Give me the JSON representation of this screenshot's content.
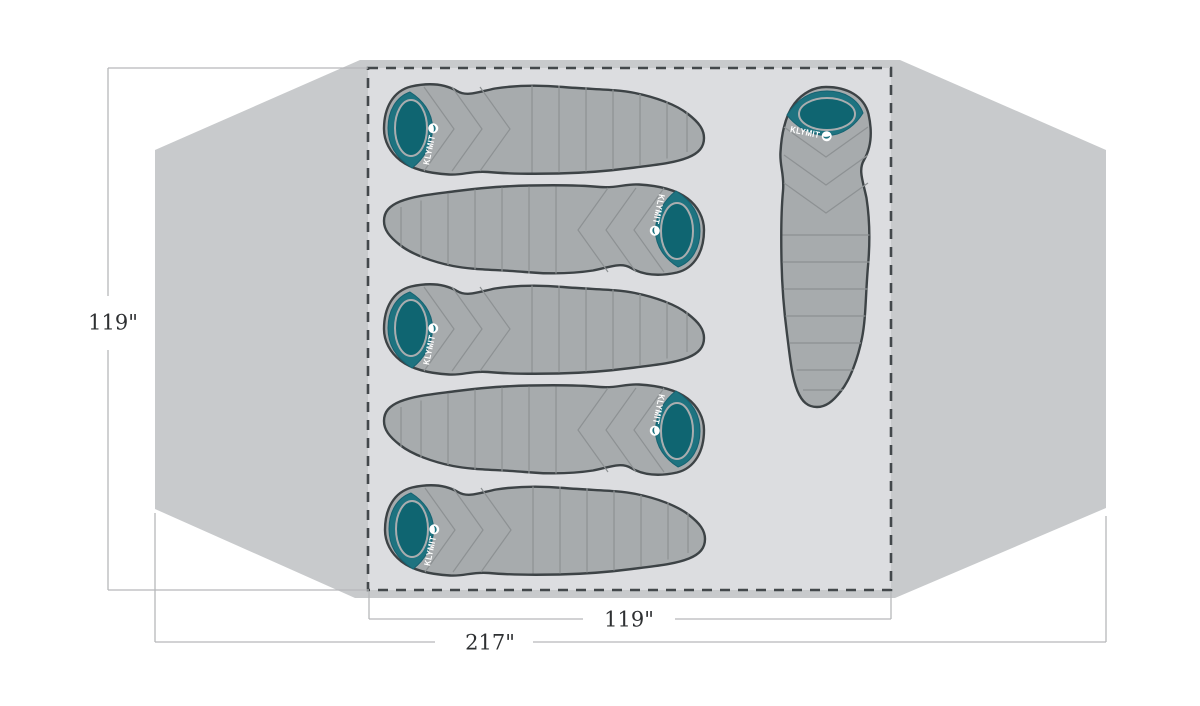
{
  "diagram": {
    "type": "tent-floorplan-top-view",
    "brand_label": "KLYMIT",
    "dimension_labels": {
      "floor_height": "119\"",
      "floor_width": "119\"",
      "tent_width": "217\""
    },
    "colors": {
      "background": "#ffffff",
      "tent_fill": "#c8cacc",
      "floor_fill": "#dcdde0",
      "dashed_border": "#43484b",
      "bag_body": "#a7abad",
      "bag_outline": "#3d4346",
      "bag_seams": "#8d9193",
      "hood_teal": "#1e7380",
      "hood_opening_teal": "#0f6571",
      "hood_ring": "#aaadaf",
      "brand_color": "#ffffff",
      "dimension_line": "#b6b8ba",
      "dimension_text": "#2e3032"
    },
    "sleeping_bags": [
      {
        "orientation": "horizontal",
        "hood_side": "left",
        "row": 1
      },
      {
        "orientation": "horizontal",
        "hood_side": "right",
        "row": 2
      },
      {
        "orientation": "horizontal",
        "hood_side": "left",
        "row": 3
      },
      {
        "orientation": "horizontal",
        "hood_side": "right",
        "row": 4
      },
      {
        "orientation": "horizontal",
        "hood_side": "left",
        "row": 5
      },
      {
        "orientation": "vertical",
        "hood_side": "top",
        "row": "right-column"
      }
    ]
  }
}
